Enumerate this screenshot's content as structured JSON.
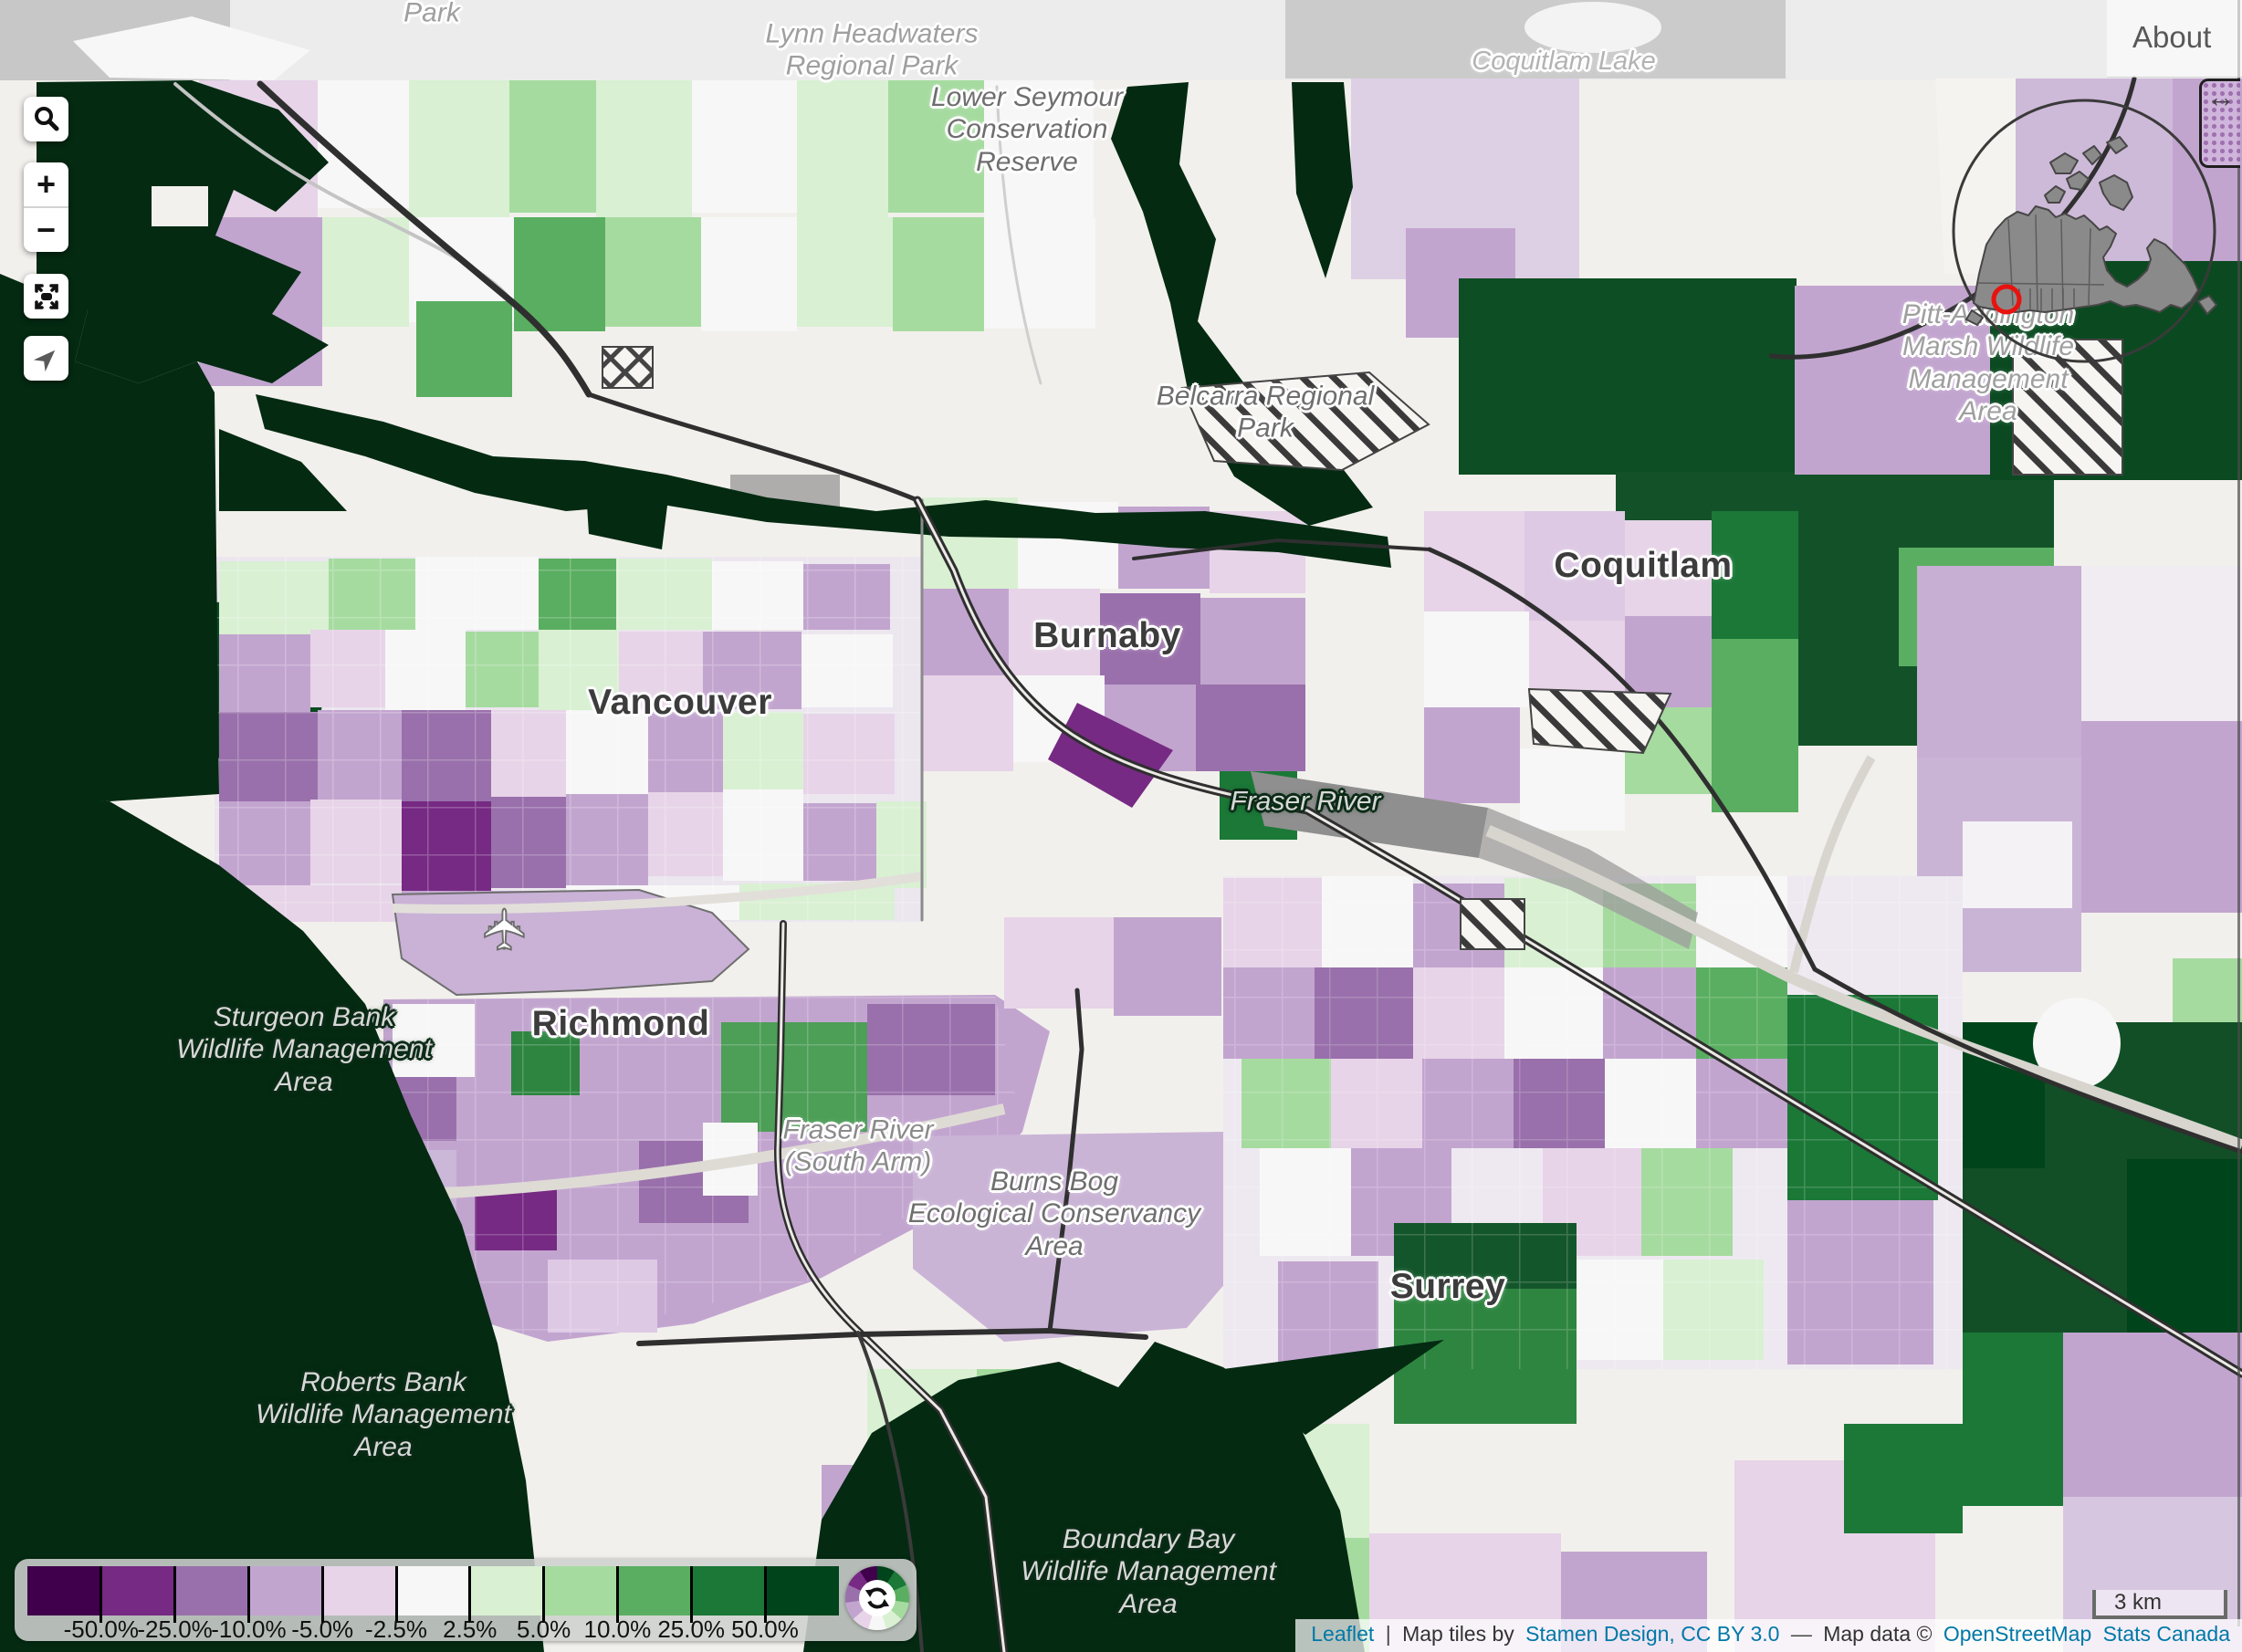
{
  "logo": {
    "row1": "山軟",
    "row2": "數體"
  },
  "controls": {
    "zoom_in": "+",
    "zoom_out": "−"
  },
  "about_label": "About",
  "handle_icon": "↔",
  "legend": {
    "ticks": [
      "-50.0%",
      "-25.0%",
      "-10.0%",
      "-5.0%",
      "-2.5%",
      "2.5%",
      "5.0%",
      "10.0%",
      "25.0%",
      "50.0%"
    ],
    "colors": [
      "#40004b",
      "#762a83",
      "#9970ab",
      "#c2a5cf",
      "#e7d4e8",
      "#f7f7f7",
      "#d9f0d3",
      "#a6dba0",
      "#5aae61",
      "#1b7837",
      "#00441b"
    ]
  },
  "scale_bar_label": "3 km",
  "attribution": {
    "leaflet": "Leaflet",
    "divider": "|",
    "tiles_prefix": "Map tiles by",
    "tiles_link": "Stamen Design, CC BY 3.0",
    "dash": "—",
    "data_prefix": "Map data ©",
    "osm_link": "OpenStreetMap",
    "statcan_link": "Stats Canada"
  },
  "map_icons": {
    "airplane": "✈"
  },
  "map_labels": {
    "park_top": {
      "lines": [
        "Park"
      ]
    },
    "lynn": {
      "lines": [
        "Lynn Headwaters",
        "Regional Park"
      ]
    },
    "seymour": {
      "lines": [
        "Lower Seymour",
        "Conservation",
        "Reserve"
      ]
    },
    "coquitlam_lake": {
      "lines": [
        "Coquitlam Lake"
      ]
    },
    "belcarra": {
      "lines": [
        "Belcarra Regional",
        "Park"
      ]
    },
    "pitt": {
      "lines": [
        "Pitt-Addington",
        "Marsh Wildlife",
        "Management",
        "Area"
      ]
    },
    "vancouver": {
      "lines": [
        "Vancouver"
      ]
    },
    "burnaby": {
      "lines": [
        "Burnaby"
      ]
    },
    "coquitlam": {
      "lines": [
        "Coquitlam"
      ]
    },
    "richmond": {
      "lines": [
        "Richmond"
      ]
    },
    "surrey": {
      "lines": [
        "Surrey"
      ]
    },
    "fraser_river": {
      "lines": [
        "Fraser River"
      ]
    },
    "fraser_south": {
      "lines": [
        "Fraser River",
        "(South Arm)"
      ]
    },
    "burns_bog": {
      "lines": [
        "Burns Bog",
        "Ecological Conservancy",
        "Area"
      ]
    },
    "sturgeon": {
      "lines": [
        "Sturgeon Bank",
        "Wildlife Management",
        "Area"
      ]
    },
    "roberts": {
      "lines": [
        "Roberts Bank",
        "Wildlife Management",
        "Area"
      ]
    },
    "boundary_bay": {
      "lines": [
        "Boundary Bay",
        "Wildlife Management",
        "Area"
      ]
    }
  }
}
